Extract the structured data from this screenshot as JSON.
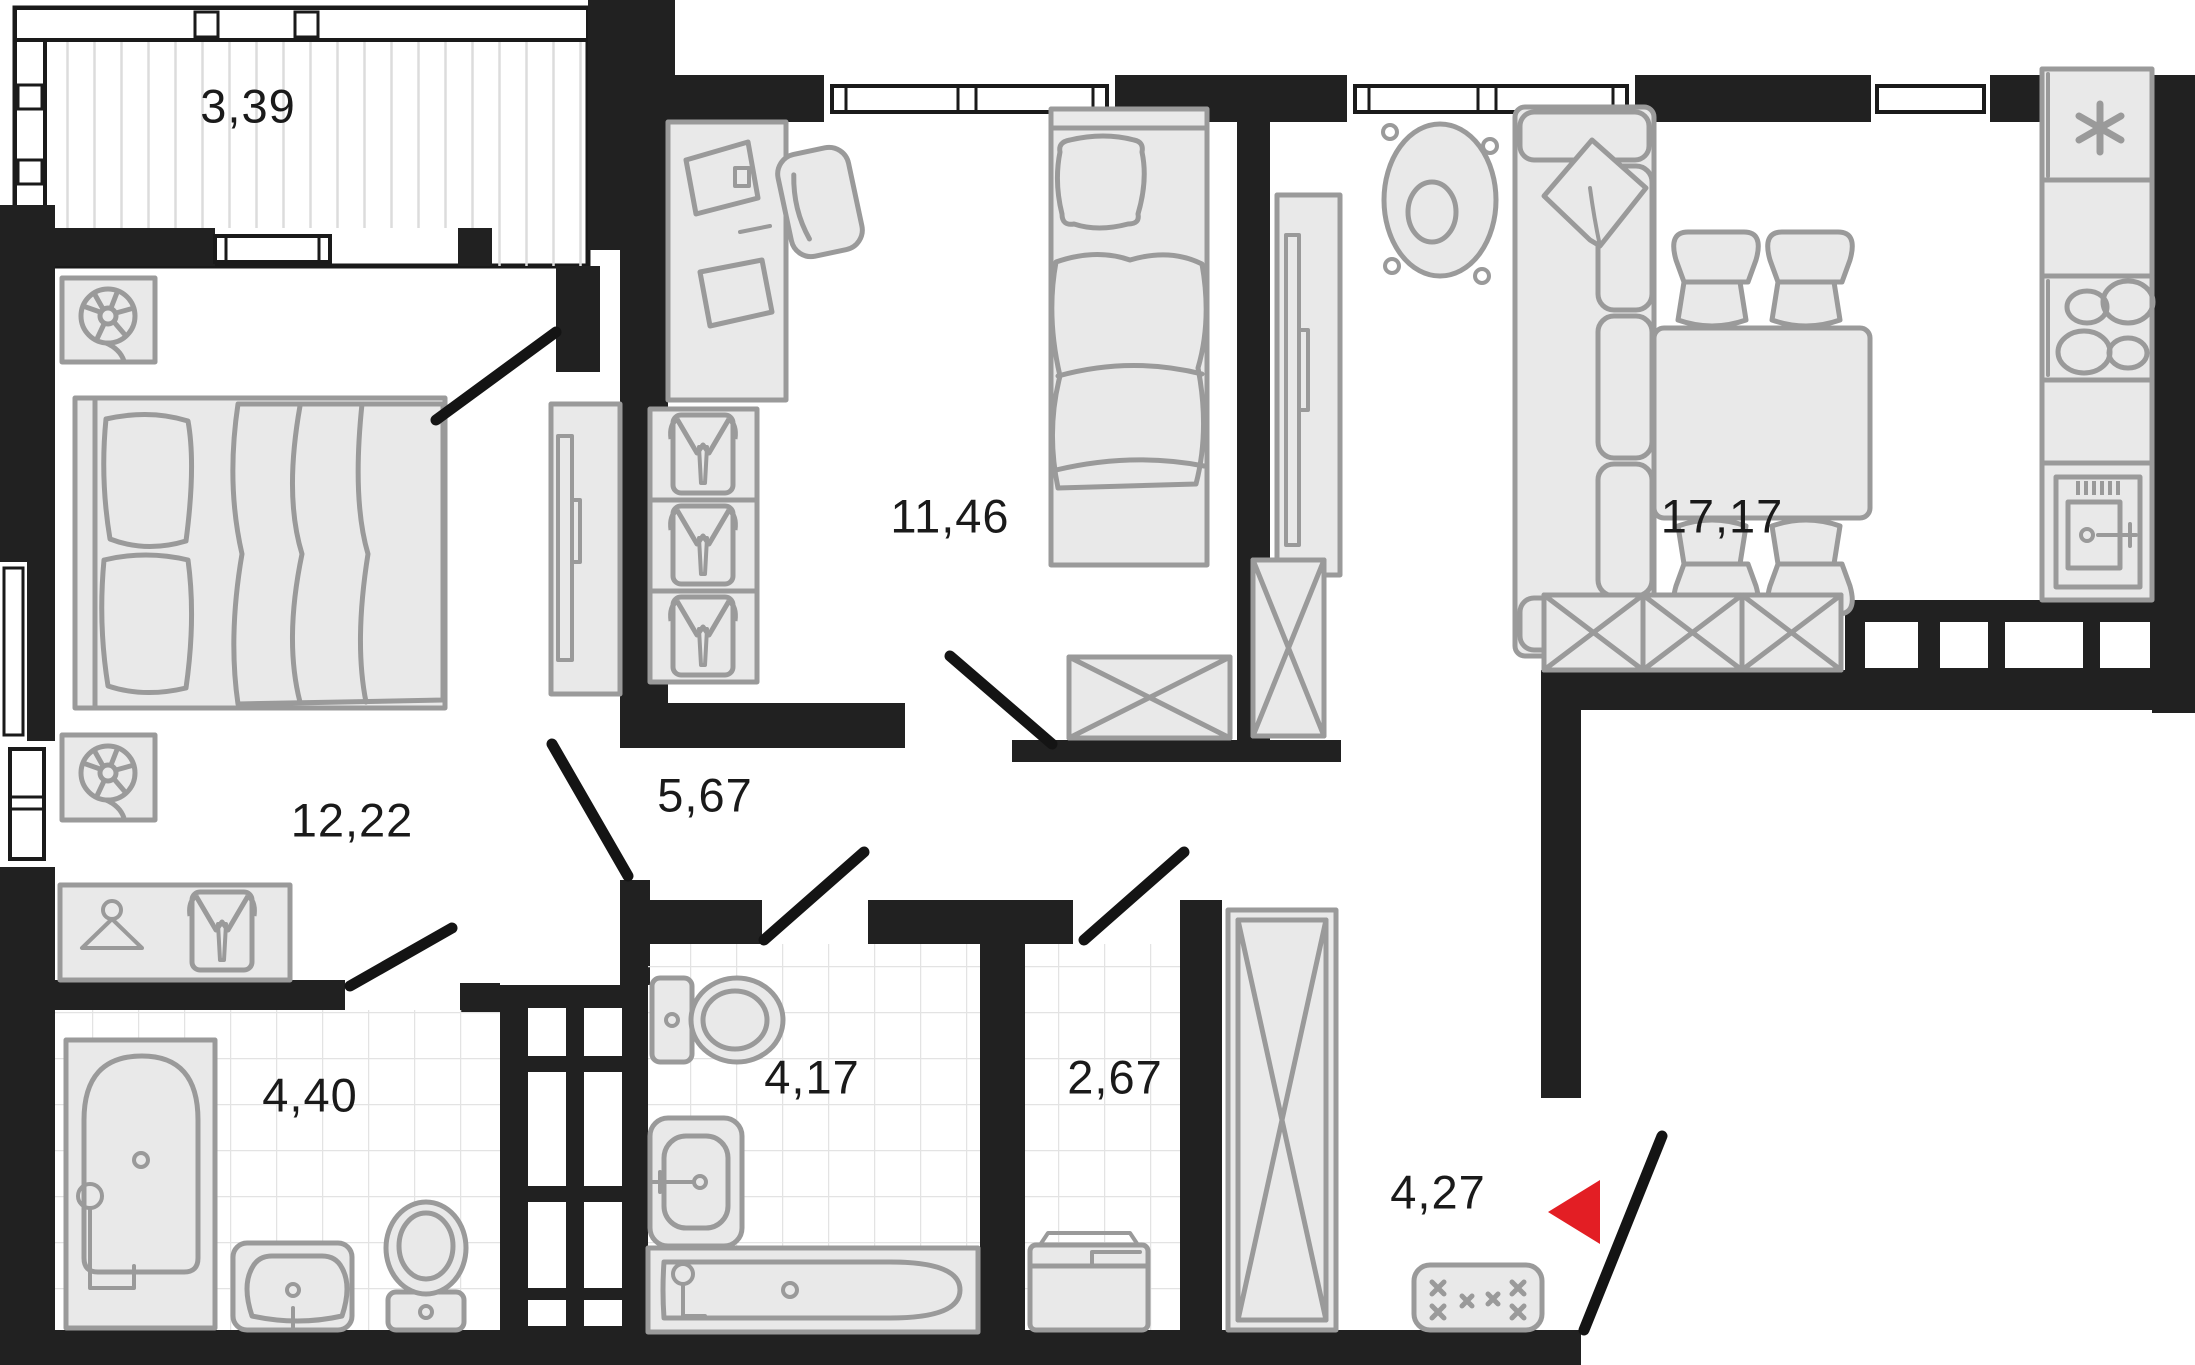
{
  "rooms": {
    "balcony": {
      "area": "3,39"
    },
    "bedroom": {
      "area": "12,22"
    },
    "bedroom_second": {
      "area": "11,46"
    },
    "living_kitchen": {
      "area": "17,17"
    },
    "hallway": {
      "area": "5,67"
    },
    "bathroom": {
      "area": "4,40"
    },
    "bathroom_guest": {
      "area": "4,17"
    },
    "laundry": {
      "area": "2,67"
    },
    "entry": {
      "area": "4,27"
    }
  },
  "colors": {
    "wall": "#212121",
    "furniture_fill": "#e9e9e9",
    "furniture_stroke": "#9a9a9a",
    "tile_line": "#e3e3e3",
    "hatch_line": "#dcdcdc",
    "entrance_marker": "#e31e24",
    "text": "#1a1a1a"
  }
}
